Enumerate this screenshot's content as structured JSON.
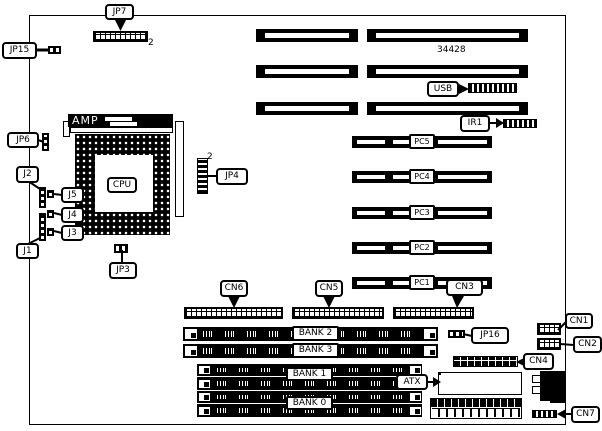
{
  "board": {
    "part_number": "34428"
  },
  "cpu": {
    "label": "CPU",
    "heatsink_label": "AMP"
  },
  "pci_slots": [
    {
      "label": "PC5"
    },
    {
      "label": "PC4"
    },
    {
      "label": "PC3"
    },
    {
      "label": "PC2"
    },
    {
      "label": "PC1"
    }
  ],
  "memory_banks": [
    {
      "label": "BANK 2"
    },
    {
      "label": "BANK 3"
    },
    {
      "label": "BANK 1"
    },
    {
      "label": "BANK 0"
    }
  ],
  "callouts": {
    "jp7": "JP7",
    "jp15": "JP15",
    "jp6": "JP6",
    "jp4": "JP4",
    "jp3": "JP3",
    "jp16": "JP16",
    "j1": "J1",
    "j2": "J2",
    "j3": "J3",
    "j4": "J4",
    "j5": "J5",
    "usb": "USB",
    "ir1": "IR1",
    "atx": "ATX",
    "cn1": "CN1",
    "cn2": "CN2",
    "cn3": "CN3",
    "cn4": "CN4",
    "cn5": "CN5",
    "cn6": "CN6",
    "cn7": "CN7"
  },
  "pin_markers": {
    "jp7": "2",
    "jp4": "2"
  }
}
